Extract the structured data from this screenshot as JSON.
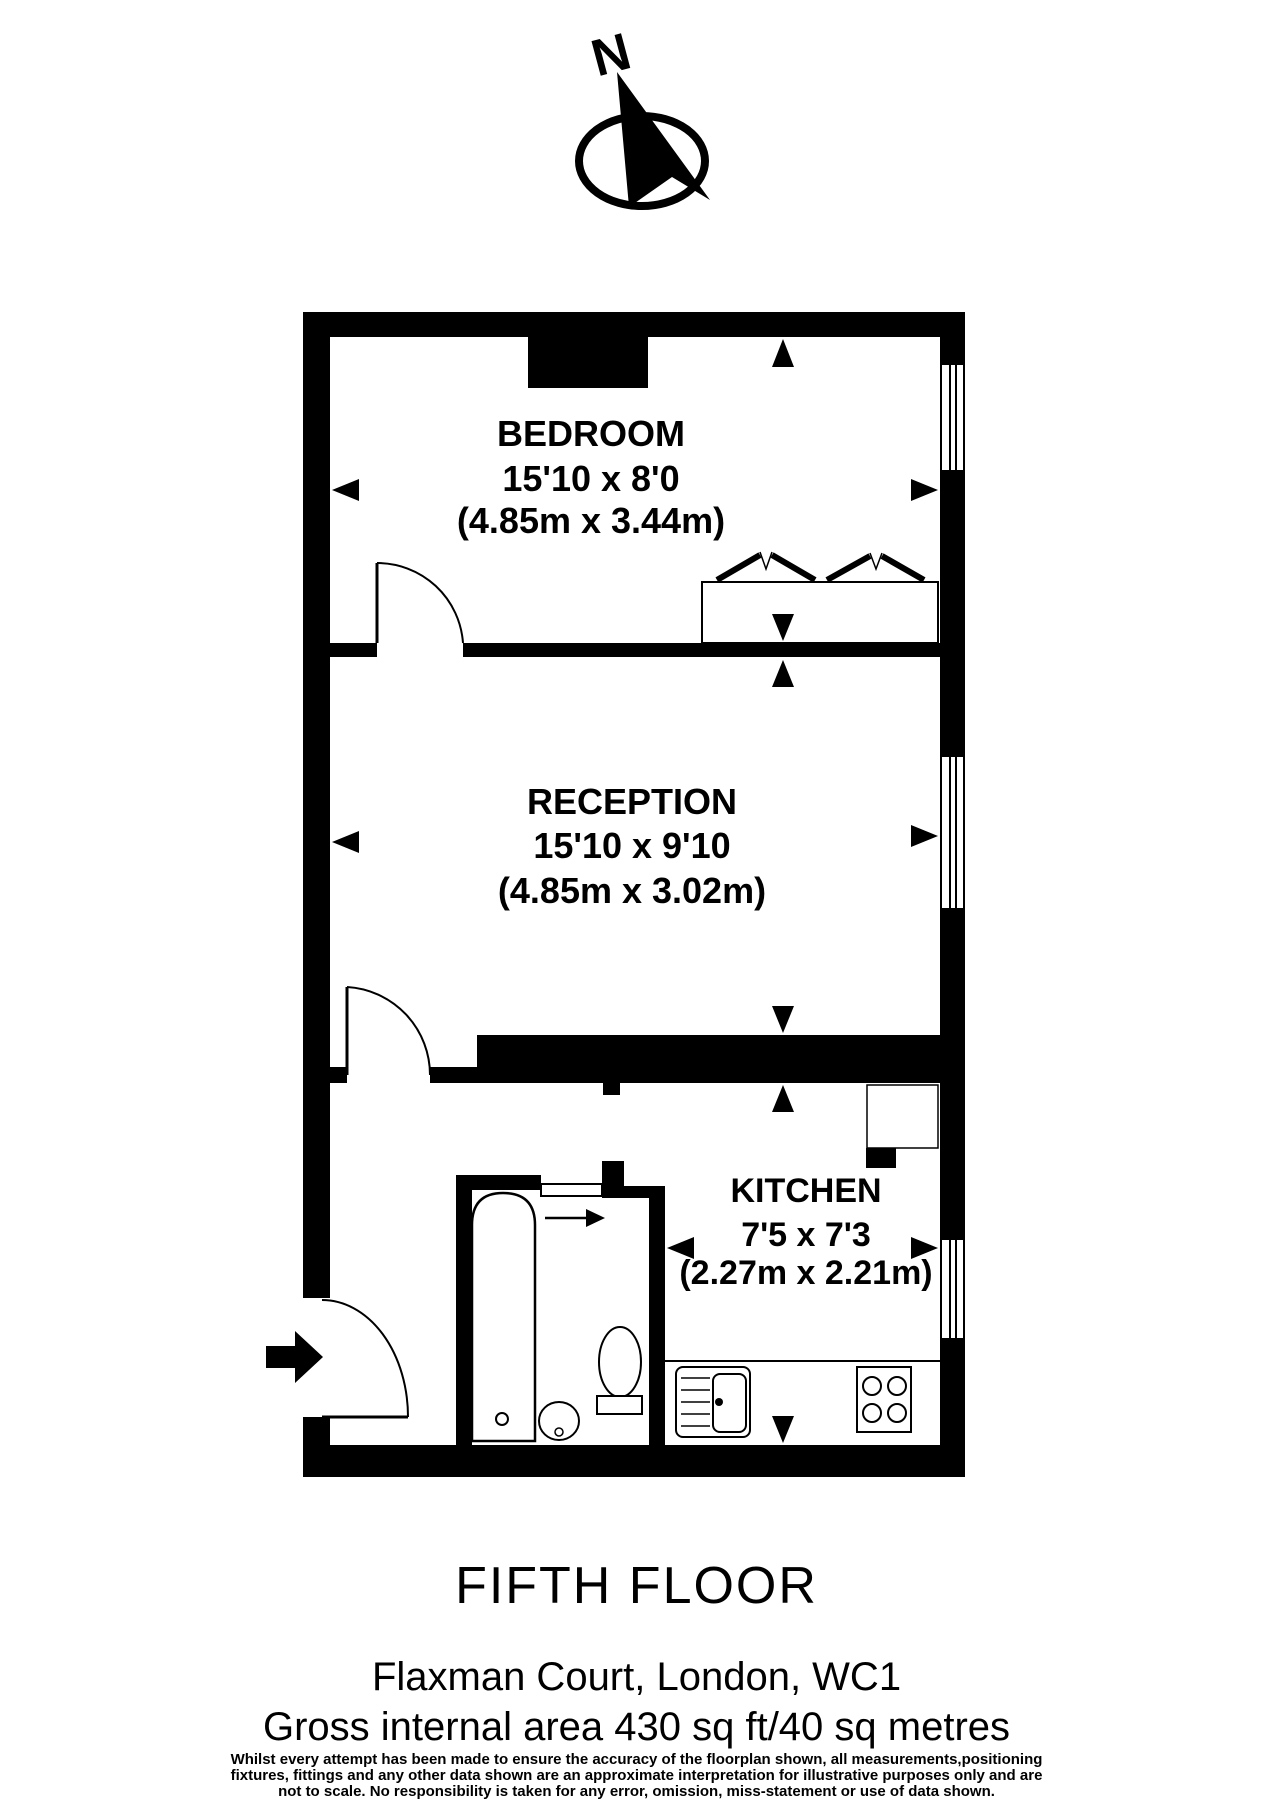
{
  "page": {
    "background": "#ffffff",
    "line_color": "#000000"
  },
  "compass": {
    "label": "N"
  },
  "rooms": [
    {
      "id": "bedroom",
      "name": "BEDROOM",
      "size_imperial": "15'10 x 8'0",
      "size_metric": "(4.85m x 3.44m)"
    },
    {
      "id": "reception",
      "name": "RECEPTION",
      "size_imperial": "15'10 x 9'10",
      "size_metric": "(4.85m x 3.02m)"
    },
    {
      "id": "kitchen",
      "name": "KITCHEN",
      "size_imperial": "7'5 x 7'3",
      "size_metric": "(2.27m x 2.21m)"
    }
  ],
  "icons": [
    "north-compass-icon",
    "entrance-arrow-icon",
    "door-icon",
    "window-icon",
    "bed-icon",
    "bath-icon",
    "basin-icon",
    "toilet-icon",
    "kitchen-sink-icon",
    "hob-icon",
    "worktop-icon",
    "dimension-arrow-icon",
    "sliding-door-icon"
  ],
  "footer": {
    "floor_title": "FIFTH FLOOR",
    "address": "Flaxman Court, London, WC1",
    "area": "Gross internal area 430 sq ft/40 sq metres",
    "disclaimer_lines": [
      "Whilst every attempt has been made to ensure the accuracy of the floorplan shown, all measurements,positioning",
      "fixtures, fittings and any other data shown are an approximate interpretation for illustrative purposes only and are",
      "not to scale. No responsibility is taken for any error, omission, miss-statement or use of data shown."
    ]
  }
}
